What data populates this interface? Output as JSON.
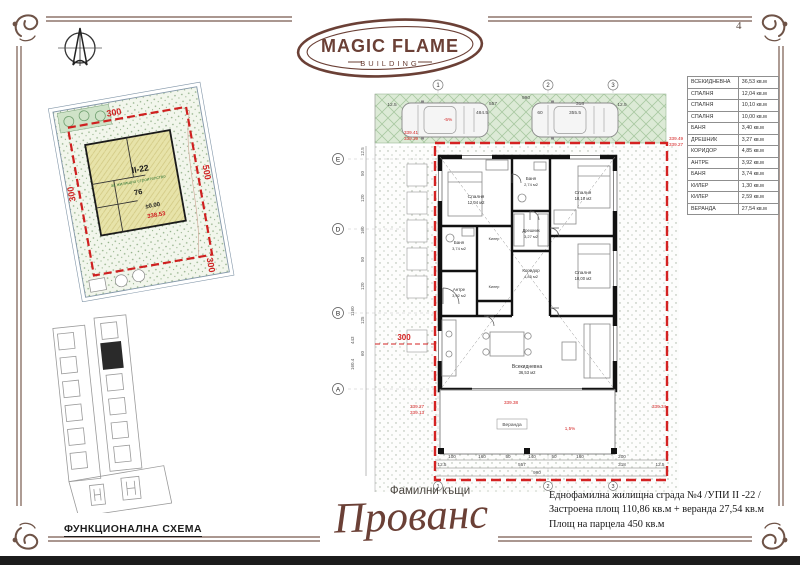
{
  "page": {
    "number": "4"
  },
  "logo": {
    "title": "MAGIC FLAME",
    "subtitle": "BUILDING"
  },
  "site_plan": {
    "dim_top": "300",
    "dim_left": "300",
    "dim_right": "500",
    "dim_bottom": "300",
    "block": "II-22",
    "zoning": "за жилищно строителство",
    "plot_number": "76",
    "elevation": "±0.00",
    "level": "338.53"
  },
  "key_map": {
    "caption": "ФУНКЦИОНАЛНА СХЕМА"
  },
  "floor_plan": {
    "grid_top": [
      "1",
      "2",
      "3"
    ],
    "grid_bottom": [
      "1",
      "2",
      "3"
    ],
    "axes": [
      "E",
      "D",
      "B",
      "A"
    ],
    "parking_dims": {
      "overall": "990",
      "margin_left": "12.5",
      "bay1": "557",
      "bay1_clear": "484.5",
      "gap": "60",
      "bay2": "318",
      "bay2_clear": "355.5",
      "margin_right": "12.5"
    },
    "levels": {
      "p1": "339.41",
      "p2": "339.39",
      "p3": "339.49",
      "p4": "339.27",
      "p5": "339.27",
      "p6": "339.13",
      "p7": "339.38",
      "p8": "339.34"
    },
    "slope_parking": "-5%",
    "slope_veranda": "1,5%",
    "red_dim": "300",
    "rooms": [
      {
        "name": "Спалня",
        "area": "12,04 м2"
      },
      {
        "name": "Баня",
        "area": "2,74 м2"
      },
      {
        "name": "Спалня",
        "area": "10,10 м2"
      },
      {
        "name": "Дрешник",
        "area": "3,27 м2"
      },
      {
        "name": "Коридор",
        "area": "4,85 м2"
      },
      {
        "name": "Спалня",
        "area": "10,00 м2"
      },
      {
        "name": "Баня",
        "area": "3,74 м2"
      },
      {
        "name": "Антре",
        "area": "3,92 м2"
      },
      {
        "name": "Килер",
        "area": "1,30 м2"
      },
      {
        "name": "Килер",
        "area": "2,59 м2"
      },
      {
        "name": "Всекидневна",
        "area": "36,53 м2"
      }
    ],
    "veranda_label": "Веранда",
    "bottom_dims": [
      "100",
      "160",
      "50",
      "140",
      "50",
      "160",
      "200"
    ],
    "bottom_dims2": [
      "12.5",
      "557",
      "318",
      "12.5"
    ],
    "bottom_total": "990",
    "left_dims": [
      "12.5",
      "50",
      "120",
      "160",
      "50",
      "120",
      "125",
      "60"
    ],
    "left_totals": [
      "1160",
      "443",
      "160.4"
    ]
  },
  "room_schedule": {
    "rows": [
      {
        "name": "ВСЕКИДНЕВНА",
        "area": "36,53 кв.м"
      },
      {
        "name": "СПАЛНЯ",
        "area": "12,04 кв.м"
      },
      {
        "name": "СПАЛНЯ",
        "area": "10,10 кв.м"
      },
      {
        "name": "СПАЛНЯ",
        "area": "10,00 кв.м"
      },
      {
        "name": "БАНЯ",
        "area": "3,40 кв.м"
      },
      {
        "name": "ДРЕШНИК",
        "area": "3,27 кв.м"
      },
      {
        "name": "КОРИДОР",
        "area": "4,85 кв.м"
      },
      {
        "name": "АНТРЕ",
        "area": "3,92 кв.м"
      },
      {
        "name": "БАНЯ",
        "area": "3,74 кв.м"
      },
      {
        "name": "КИЛЕР",
        "area": "1,30 кв.м"
      },
      {
        "name": "КИЛЕР",
        "area": "2,59 кв.м"
      },
      {
        "name": "ВЕРАНДА",
        "area": "27,54 кв.м"
      }
    ]
  },
  "footer": {
    "series": "Фамилни къщи",
    "model": "Прованс",
    "description": [
      "Еднофамилна жилищна сграда №4 /УПИ II -22 /",
      "Застроена площ 110,86 кв.м + веранда 27,54 кв.м",
      "Площ на парцела 450 кв.м"
    ]
  }
}
